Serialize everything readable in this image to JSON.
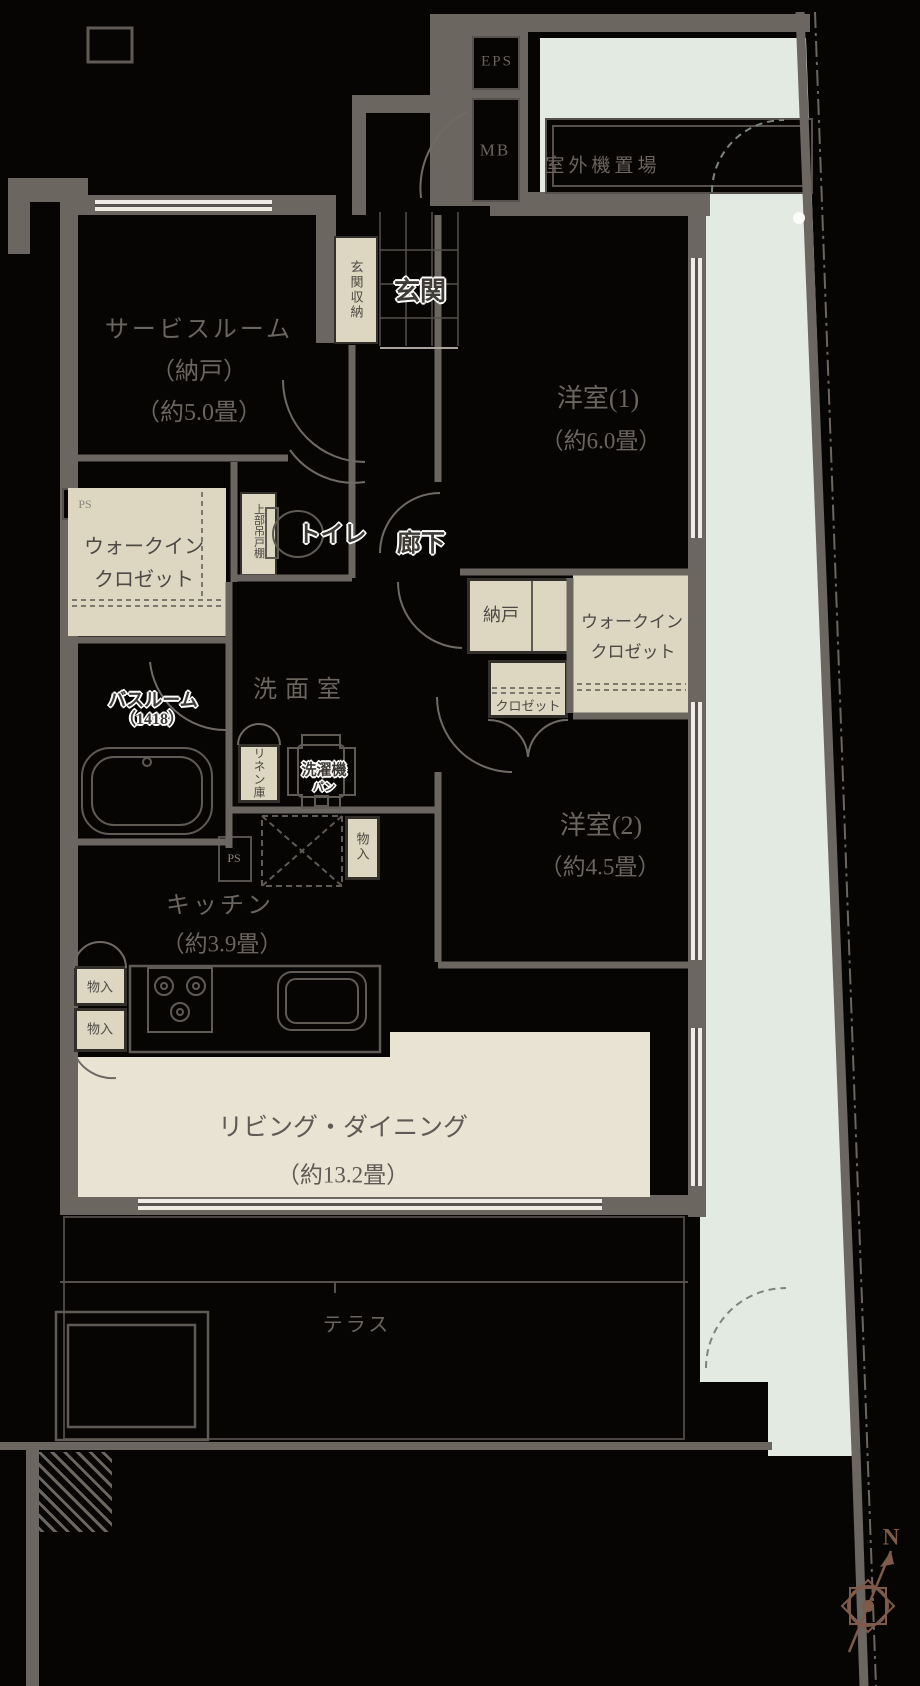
{
  "colors": {
    "background": "#070404",
    "wall": "#6b6660",
    "beige": "#ddd6c1",
    "living_beige": "#e9e3d4",
    "mint_exterior": "#e2eae1",
    "line": "#6f6a64",
    "text_gray": "#6b655f",
    "compass_brown": "#7d5a49"
  },
  "rooms": {
    "service": {
      "line1": "サービスルーム",
      "line2": "（納戸）",
      "line3": "（約5.0畳）"
    },
    "western1": {
      "name": "洋室(1)",
      "size": "（約6.0畳）"
    },
    "western2": {
      "name": "洋室(2)",
      "size": "（約4.5畳）"
    },
    "kitchen": {
      "name": "キッチン",
      "size": "（約3.9畳）"
    },
    "living_dining": {
      "name": "リビング・ダイニング",
      "size": "（約13.2畳）"
    },
    "washroom": {
      "name": "洗面室"
    },
    "bathroom": {
      "name": "バスルーム",
      "size": "（1418）"
    },
    "entrance": {
      "name": "玄関"
    },
    "corridor": {
      "name": "廊下"
    },
    "toilet": {
      "name": "トイレ"
    },
    "terrace": {
      "name": "テラス"
    },
    "outdoor_unit": {
      "name": "室外機置場"
    }
  },
  "storage": {
    "entrance_storage": "玄関収納",
    "wic_line1": "ウォークイン",
    "wic_line2": "クロゼット",
    "nando": "納戸",
    "closet": "クロゼット",
    "linen": "リネン庫",
    "upper_cabinet": "上部吊戸棚",
    "washer_pan_line1": "洗濯機",
    "washer_pan_line2": "パン",
    "mono_ire": "物入"
  },
  "utility": {
    "eps": "EPS",
    "mb": "MB",
    "ps": "PS"
  },
  "compass": {
    "north": "N"
  }
}
